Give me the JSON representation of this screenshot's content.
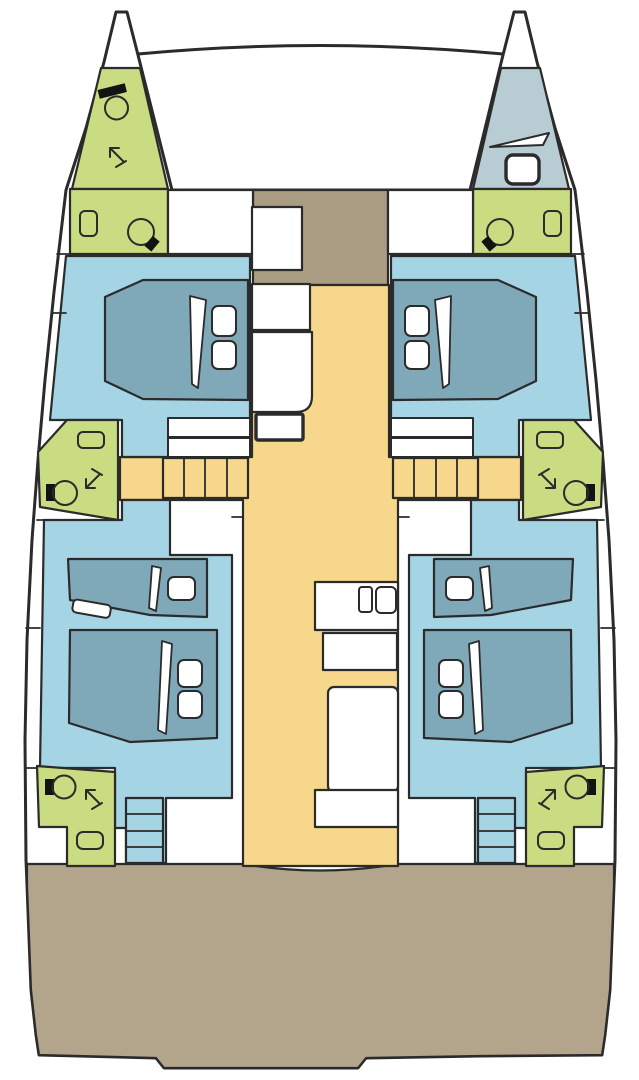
{
  "meta": {
    "description": "Top-down interior deck plan of a sailing catamaran with four guest cabins, heads and central salon",
    "view": "deck-plan",
    "orientation": "bow-up"
  },
  "colors": {
    "white": "#ffffff",
    "outline": "#2b2b2b",
    "cabin": "#a5d5e5",
    "bed": "#7fa9b8",
    "bathroom": "#c9dc81",
    "crew": "#b7ccd3",
    "salon": "#f6d78b",
    "deck": "#b3a48c",
    "foredeck": "#ab9c84",
    "fixture_dark": "#131313"
  },
  "regions": {
    "port_forepeak": {
      "label": "forepeak-head",
      "fill": "bathroom",
      "fixtures": [
        "toilet",
        "shower-arrow"
      ]
    },
    "starboard_forepeak": {
      "label": "forepeak-crew-berth",
      "fill": "crew",
      "fixtures": [
        "berth-wedge",
        "deck-hatch"
      ]
    },
    "port_forward_vanity": {
      "label": "washbasin-area",
      "fill": "bathroom",
      "fixtures": [
        "sink",
        "porthole"
      ]
    },
    "starboard_forward_vanity": {
      "label": "washbasin-area",
      "fill": "bathroom",
      "fixtures": [
        "sink",
        "porthole"
      ]
    },
    "port_forward_cabin": {
      "label": "guest-cabin-double",
      "fill": "cabin",
      "fixtures": [
        "double-bed",
        "two-pillows",
        "wardrobe"
      ]
    },
    "starboard_forward_cabin": {
      "label": "guest-cabin-double",
      "fill": "cabin",
      "fixtures": [
        "double-bed",
        "two-pillows",
        "wardrobe"
      ]
    },
    "port_mid_head": {
      "label": "head-with-shower",
      "fill": "bathroom",
      "fixtures": [
        "toilet",
        "shower-arrow",
        "porthole"
      ]
    },
    "starboard_mid_head": {
      "label": "head-with-shower",
      "fill": "bathroom",
      "fixtures": [
        "toilet",
        "shower-arrow",
        "porthole"
      ]
    },
    "port_aft_cabin": {
      "label": "guest-cabin-double-plus-single",
      "fill": "cabin",
      "fixtures": [
        "single-bed",
        "double-bed",
        "three-pillows"
      ]
    },
    "starboard_aft_cabin": {
      "label": "guest-cabin-double-plus-single",
      "fill": "cabin",
      "fixtures": [
        "single-bed",
        "double-bed",
        "three-pillows"
      ]
    },
    "port_aft_head": {
      "label": "head-with-shower",
      "fill": "bathroom",
      "fixtures": [
        "toilet",
        "shower-arrow",
        "porthole"
      ]
    },
    "starboard_aft_head": {
      "label": "head-with-shower",
      "fill": "bathroom",
      "fixtures": [
        "toilet",
        "shower-arrow",
        "porthole"
      ]
    },
    "salon": {
      "label": "salon-and-galley",
      "fill": "salon",
      "fixtures": [
        "galley-counters",
        "twin-sink-basins",
        "chart-table",
        "companionway-stairs-port",
        "companionway-stairs-starboard"
      ]
    },
    "foredeck": {
      "label": "foredeck",
      "fill": "foredeck",
      "fixtures": [
        "deck-locker-hatch"
      ]
    },
    "cockpit": {
      "label": "aft-cockpit-deck",
      "fill": "deck",
      "fixtures": []
    },
    "port_aft_steps": {
      "label": "transom-steps",
      "fill": "cabin",
      "fixtures": []
    },
    "starboard_aft_steps": {
      "label": "transom-steps",
      "fill": "cabin",
      "fixtures": []
    }
  },
  "fixture_counts": {
    "double_beds": 4,
    "single_beds": 2,
    "crew_berths": 1,
    "toilets": 5,
    "sinks": 2,
    "shower_arrows": 5,
    "companionway_stairs": 2,
    "transom_steps": 2,
    "portholes": 6,
    "deck_hatches": 2,
    "stair_treads_per_companionway": 4
  }
}
